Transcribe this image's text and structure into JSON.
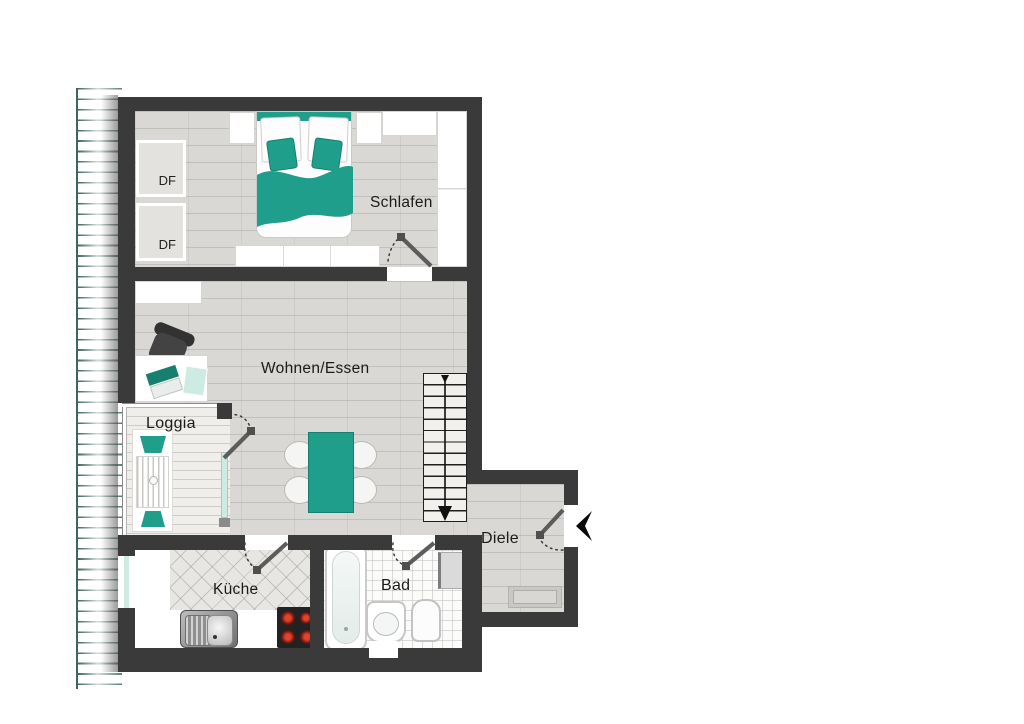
{
  "colors": {
    "wall": "#3a3a3a",
    "accent_teal": "#1f9e8c",
    "accent_teal_dark": "#15806f",
    "glass_teal": "#cdeae3",
    "floor_wood": "#d9d8d4",
    "floor_light": "#efeeea",
    "hatch_line": "#3e655e",
    "label_text": "#1b1b1b"
  },
  "rooms": {
    "bedroom": {
      "label": "Schlafen"
    },
    "living": {
      "label": "Wohnen/Essen"
    },
    "loggia": {
      "label": "Loggia"
    },
    "kitchen": {
      "label": "Küche"
    },
    "bath": {
      "label": "Bad"
    },
    "hall": {
      "label": "Diele"
    }
  },
  "roof_windows": [
    {
      "label": "DF"
    },
    {
      "label": "DF"
    }
  ]
}
